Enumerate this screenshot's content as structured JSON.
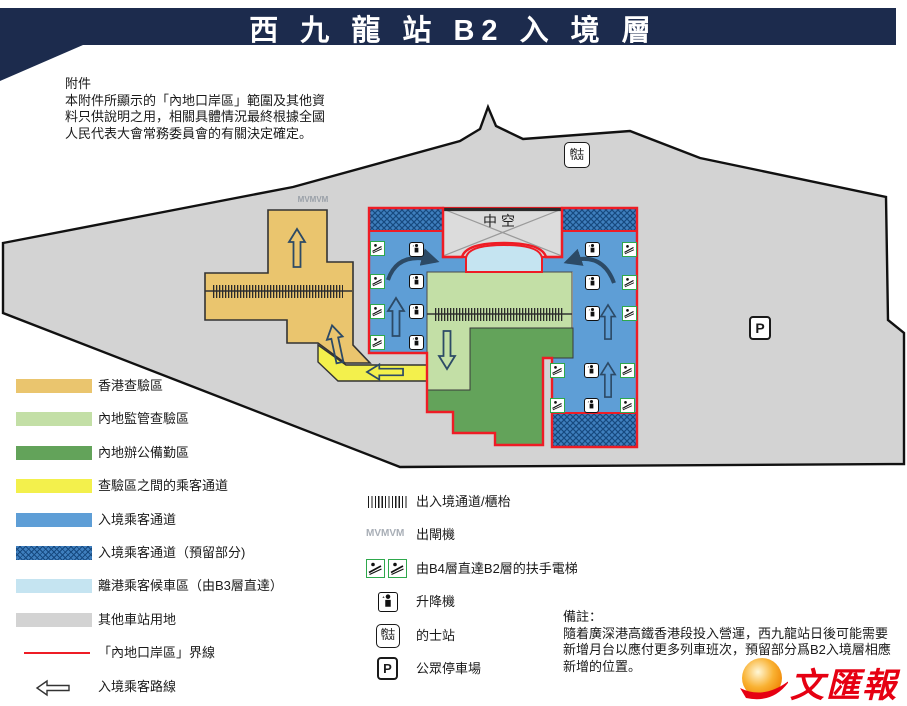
{
  "banner": {
    "title": "西 九 龍 站 B2 入 境 層"
  },
  "attachment_note": {
    "heading": "附件",
    "lines": [
      "本附件所顯示的「內地口岸區」範圍及其他資",
      "料只供說明之用，相關具體情況最終根據全國",
      "人民代表大會常務委員會的有關決定確定。"
    ]
  },
  "remark_note": {
    "heading": "備註：",
    "lines": [
      "隨着廣深港高鐵香港段投入營運，西九龍站日後可能需要",
      "新增月台以應付更多列車班次，預留部分爲B2入境層相應",
      "新增的位置。"
    ]
  },
  "map_labels": {
    "void_label": "中空",
    "gate_symbol": "MVMVM",
    "taxi_line1": "的士",
    "taxi_line2": "TAXI",
    "parking": "P"
  },
  "area_legend": [
    {
      "id": "hk-inspection",
      "label": "香港查驗區",
      "swatch": "orange"
    },
    {
      "id": "mainland-inspection",
      "label": "內地監管查驗區",
      "swatch": "lightgreen"
    },
    {
      "id": "mainland-office",
      "label": "內地辦公備勤區",
      "swatch": "green"
    },
    {
      "id": "between-passage",
      "label": "查驗區之間的乘客通道",
      "swatch": "yellow"
    },
    {
      "id": "arrival-corridor",
      "label": "入境乘客通道",
      "swatch": "blue"
    },
    {
      "id": "arrival-reserved",
      "label": "入境乘客通道（預留部分)",
      "swatch": "hatch"
    },
    {
      "id": "departure-waiting",
      "label": "離港乘客候車區（由B3層直達）",
      "swatch": "cyan"
    },
    {
      "id": "other-station",
      "label": "其他車站用地",
      "swatch": "gray"
    },
    {
      "id": "port-boundary",
      "label": "「內地口岸區」界線",
      "swatch": "redline"
    },
    {
      "id": "arrival-route",
      "label": "入境乘客路線",
      "swatch": "arrow"
    }
  ],
  "symbol_legend": [
    {
      "id": "counters",
      "label": "出入境通道/櫃枱",
      "icon": "hatchbar"
    },
    {
      "id": "exit-gates",
      "label": "出閘機",
      "icon": "gates"
    },
    {
      "id": "escalators",
      "label": "由B4層直達B2層的扶手電梯",
      "icon": "escpair"
    },
    {
      "id": "lift",
      "label": "升降機",
      "icon": "elevator"
    },
    {
      "id": "taxi-stand",
      "label": "的士站",
      "icon": "taxi"
    },
    {
      "id": "parking",
      "label": "公眾停車場",
      "icon": "parking"
    }
  ],
  "colors": {
    "banner_navy": "#1c2b4d",
    "station_gray": "#d3d3d3",
    "void_gray": "#dcdcdc",
    "hk_orange": "#eac56e",
    "passage_yellow": "#f3f04c",
    "inspection_light_green": "#c3dfa6",
    "office_green": "#63a35a",
    "corridor_blue": "#5e9ed6",
    "reserved_blue": "#3f7fbe",
    "reserved_line": "#16497f",
    "waiting_cyan": "#c5e4f1",
    "boundary_red": "#ee1c25",
    "outline_black": "#1a1a1a",
    "arrow_gray": "#2c4a66",
    "escalator_green": "#2ea84c",
    "logo_red": "#e60012"
  },
  "map_icons": {
    "escalators": [
      [
        377,
        248
      ],
      [
        377,
        281
      ],
      [
        377,
        311
      ],
      [
        377,
        342
      ],
      [
        629,
        249
      ],
      [
        629,
        282
      ],
      [
        629,
        313
      ],
      [
        557,
        370
      ],
      [
        627,
        370
      ],
      [
        557,
        405
      ],
      [
        627,
        405
      ]
    ],
    "elevators": [
      [
        416,
        249
      ],
      [
        416,
        281
      ],
      [
        416,
        311
      ],
      [
        416,
        342
      ],
      [
        592,
        249
      ],
      [
        592,
        282
      ],
      [
        592,
        313
      ],
      [
        591,
        370
      ],
      [
        591,
        405
      ]
    ]
  },
  "logo": {
    "text": "文匯報"
  }
}
